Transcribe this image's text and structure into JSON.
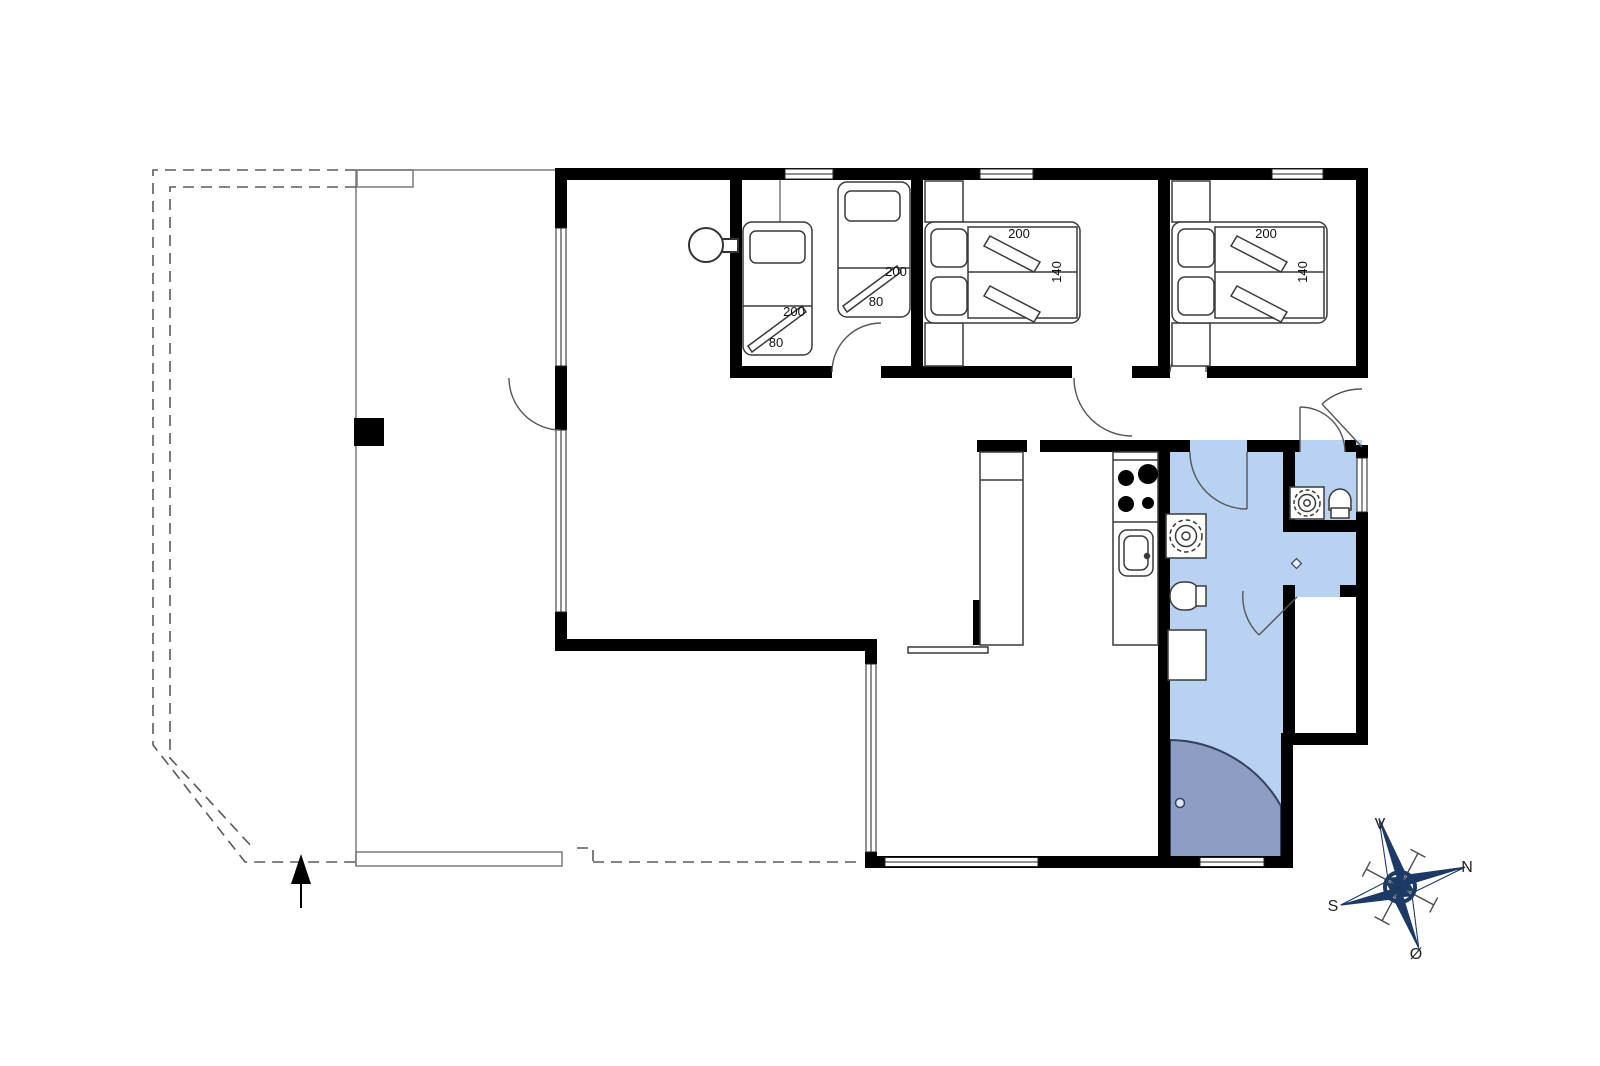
{
  "floorplan": {
    "bedroom1": {
      "bed_a": {
        "length_label": "200",
        "width_label": "80"
      },
      "bed_b": {
        "length_label": "200",
        "width_label": "80"
      }
    },
    "bedroom2": {
      "bed": {
        "length_label": "200",
        "width_label": "140"
      }
    },
    "bedroom3": {
      "bed": {
        "length_label": "200",
        "width_label": "140"
      }
    },
    "compass": {
      "top": "V",
      "right": "N",
      "left": "S",
      "bottom": "Ø"
    },
    "colors": {
      "wall": "#000000",
      "wet_room_fill": "#b9d2f1",
      "shower_fill": "#8d9dc3",
      "compass_star": "#1d3a67",
      "outline": "#3a3a3a"
    },
    "icons": [
      "wood-stove-icon",
      "hob-icon",
      "kitchen-sink-icon",
      "washbasin-icon",
      "toilet-icon",
      "shower-icon",
      "floor-drain-icon",
      "compass-rose-icon",
      "entrance-arrow-icon"
    ]
  }
}
